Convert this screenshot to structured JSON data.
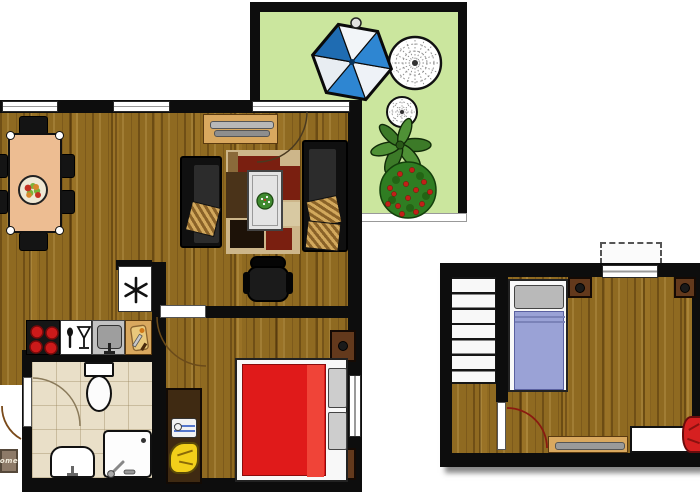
{
  "title": "apartment-floor-plan",
  "doormat": {
    "text": "ome"
  },
  "palette": {
    "wall": "#0d0d0d",
    "wood_floor": "#8f6a21",
    "terrace_green": "#cbe69e",
    "bathroom_tile": "#e9dfc8",
    "bed_red": "#e01a1a",
    "annex_blanket_blue": "#9aa2d6",
    "parasol_blue": "#2e86d2",
    "plant_green": "#3c7a28",
    "bush_green": "#2f7d22",
    "flower_red": "#c22018",
    "cabinet_tan": "#d9a85f",
    "dining_table_tan": "#edbd92",
    "chair_yellow": "#f2cf1a",
    "sofa_black": "#151515"
  },
  "apartment": {
    "rooms": [
      {
        "name": "living-dining-room",
        "floor": "wood-parquet",
        "furniture": [
          "dining-table",
          "six-black-chairs",
          "fruit-bowl",
          "sideboard-with-radiator",
          "sofa-left",
          "sofa-right",
          "patchwork-rug",
          "coffee-table-with-plant",
          "office-chair"
        ],
        "windows": 2
      },
      {
        "name": "kitchen",
        "floor": "wood-parquet",
        "furniture": [
          "stove-four-burners",
          "dishwasher",
          "kitchen-sink",
          "cutting-board-counter",
          "refrigerator-freezer"
        ]
      },
      {
        "name": "bathroom",
        "floor": "beige-tile",
        "furniture": [
          "toilet",
          "washbasin",
          "shower"
        ]
      },
      {
        "name": "bedroom",
        "floor": "wood-parquet",
        "furniture": [
          "double-bed-red",
          "two-pillows",
          "nightstand-top",
          "nightstand-bottom",
          "desk-with-sewing-machine",
          "yellow-chair"
        ],
        "windows": 1
      }
    ],
    "doors": [
      "terrace-door",
      "bedroom-door",
      "bathroom-door",
      "entry-door"
    ]
  },
  "terrace": {
    "floor": "green",
    "items": [
      "parasol-blue-white",
      "round-lace-table",
      "round-lace-chair",
      "green-leaf-plant",
      "red-flower-bush"
    ]
  },
  "annex": {
    "rooms": [
      {
        "name": "attic-room",
        "floor": "wood-parquet",
        "furniture": [
          "staircase",
          "single-bed-blue",
          "nightstand-left",
          "nightstand-right",
          "skylight-window",
          "bench-desk",
          "white-cabinet",
          "red-armchair"
        ],
        "doors": [
          "room-door"
        ]
      }
    ]
  },
  "icons": {
    "freezer": "asterisk-snowflake",
    "dishwasher": "spoon-and-glass",
    "cutting_board": "board-with-knife"
  }
}
